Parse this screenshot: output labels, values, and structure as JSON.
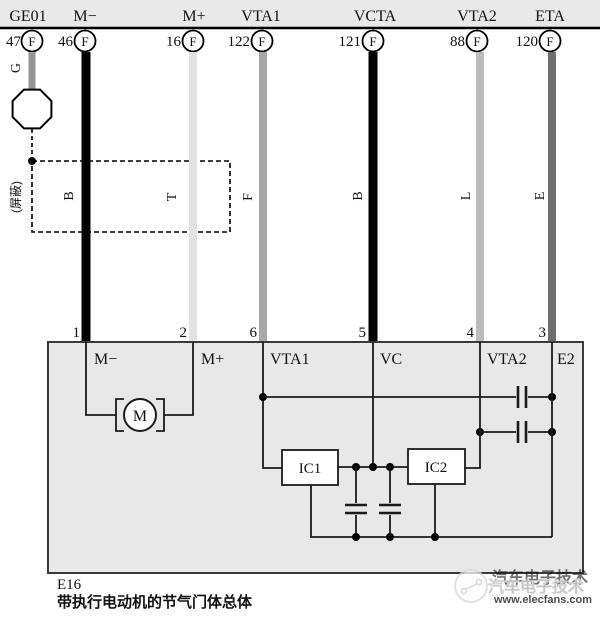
{
  "header": {
    "terminals": [
      {
        "name": "GE01",
        "pin": "47",
        "connector": "F",
        "wire_color": "G"
      },
      {
        "name": "M−",
        "pin": "46",
        "connector": "F",
        "wire_color": "B"
      },
      {
        "name": "M+",
        "pin": "16",
        "connector": "F",
        "wire_color": "T"
      },
      {
        "name": "VTA1",
        "pin": "122",
        "connector": "F",
        "wire_color": "F"
      },
      {
        "name": "VCTA",
        "pin": "121",
        "connector": "F",
        "wire_color": "B"
      },
      {
        "name": "VTA2",
        "pin": "88",
        "connector": "F",
        "wire_color": "L"
      },
      {
        "name": "ETA",
        "pin": "120",
        "connector": "F",
        "wire_color": "E"
      }
    ]
  },
  "shield_label": "(屏蔽)",
  "throttle_body": {
    "id": "E16",
    "caption": "带执行电动机的节气门体总体",
    "pins": [
      {
        "number": "1",
        "label": "M−"
      },
      {
        "number": "2",
        "label": "M+"
      },
      {
        "number": "6",
        "label": "VTA1"
      },
      {
        "number": "5",
        "label": "VC"
      },
      {
        "number": "4",
        "label": "VTA2"
      },
      {
        "number": "3",
        "label": "E2"
      }
    ],
    "motor_label": "M",
    "ic1_label": "IC1",
    "ic2_label": "IC2"
  },
  "watermark": {
    "text_cn": "汽车电子技术",
    "url": "www.elecfans.com"
  },
  "colors": {
    "wire_g": "#969696",
    "wire_b": "#000000",
    "wire_t": "#e2e2e2",
    "wire_f": "#a8a8a8",
    "wire_vcta": "#000000",
    "wire_l": "#bcbcbc",
    "wire_e": "#6f6f6f",
    "header_fill": "#e9e9e9",
    "box_fill": "#e8e8e8",
    "watermark_pink": "#e8a7a7"
  }
}
